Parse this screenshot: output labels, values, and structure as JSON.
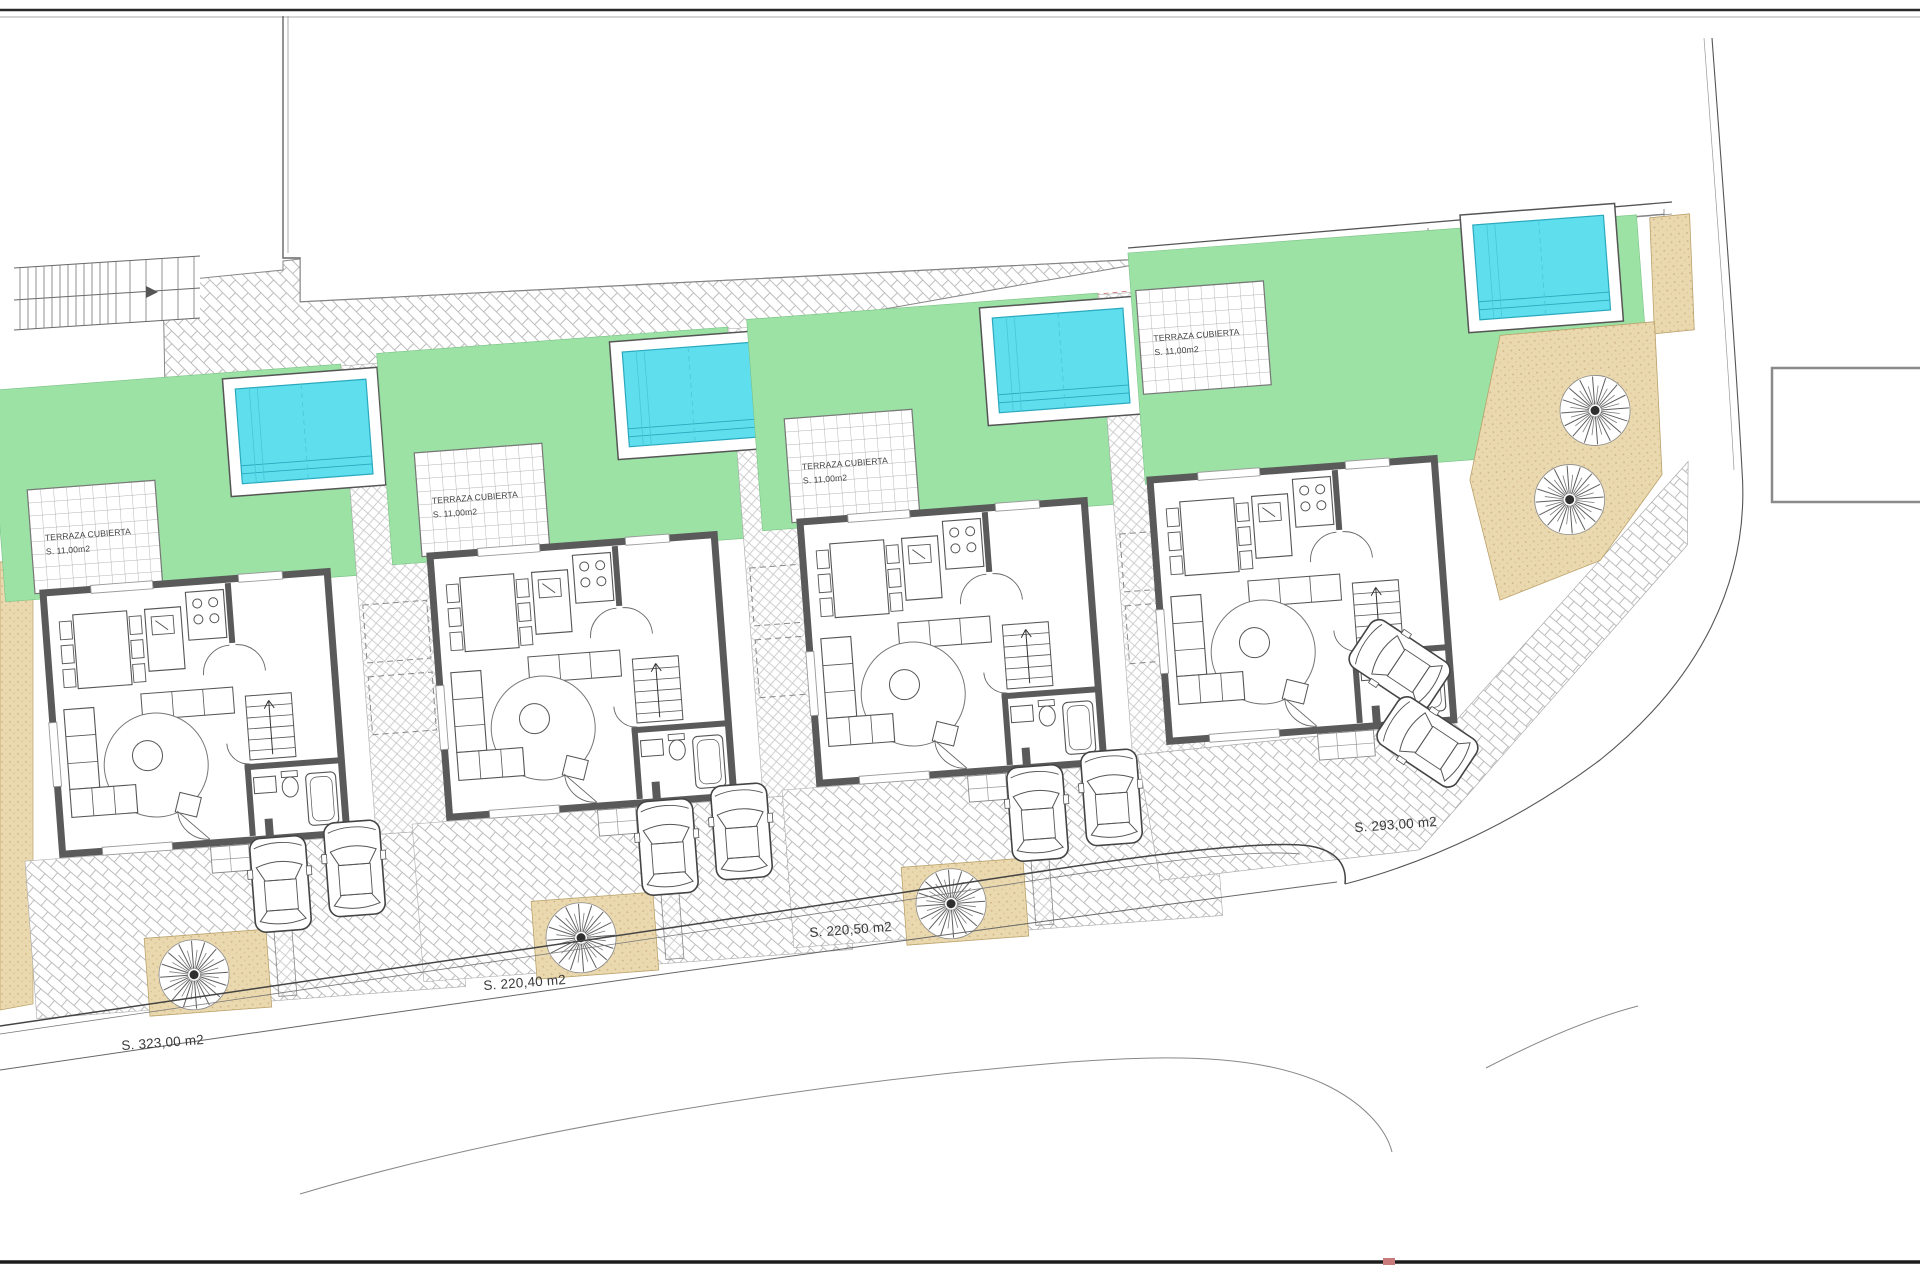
{
  "drawing": {
    "type": "architectural-site-plan",
    "description": "Site plan of four detached villas with pools, covered terraces, lawns, paved driveways, parked cars and trees"
  },
  "terrace": {
    "line1": "TERRAZA CUBIERTA",
    "line2": "S. 11,00m2"
  },
  "plots": [
    {
      "id": "plot-1",
      "label": "S. 323,00 m2"
    },
    {
      "id": "plot-2",
      "label": "S. 220,40 m2"
    },
    {
      "id": "plot-3",
      "label": "S. 220,50 m2"
    },
    {
      "id": "plot-4",
      "label": "S. 293,00 m2"
    }
  ],
  "villas": [
    {
      "id": "villa-1",
      "pool": true,
      "covered_terrace": true,
      "cars": 2,
      "tree": true
    },
    {
      "id": "villa-2",
      "pool": true,
      "covered_terrace": true,
      "cars": 2,
      "tree": true
    },
    {
      "id": "villa-3",
      "pool": true,
      "covered_terrace": true,
      "cars": 2,
      "tree": true
    },
    {
      "id": "villa-4",
      "pool": true,
      "covered_terrace": true,
      "cars": 2,
      "tree": true
    }
  ],
  "colors": {
    "lawn": "#9be2a4",
    "pool_water": "#5fdeee",
    "pool_edge": "#2aa9bd",
    "gravel": "#ead8ae",
    "wall": "#5a5a5a",
    "paving_line": "#bdbdbd",
    "boundary": "#555555",
    "red_dash": "#cc7a7a"
  }
}
